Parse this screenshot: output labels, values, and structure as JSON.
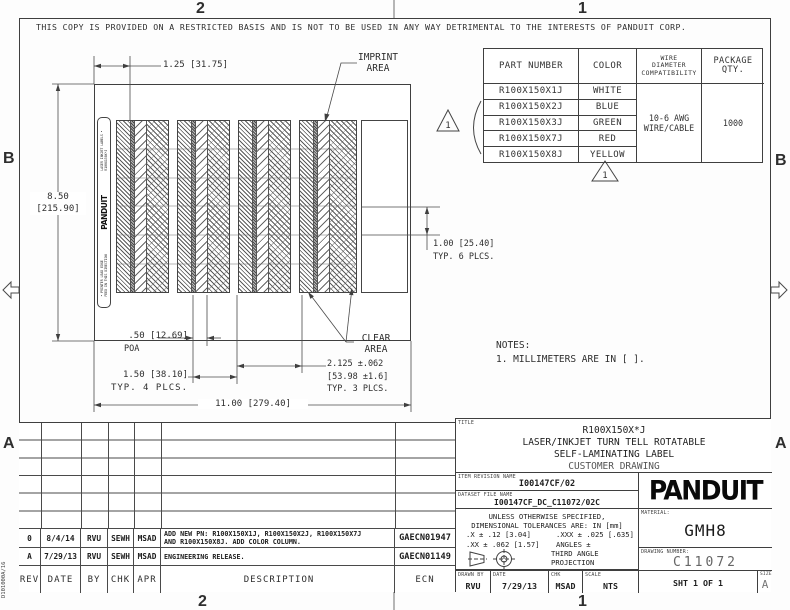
{
  "zone_labels": {
    "top_left": "2",
    "top_right": "1",
    "bottom_left": "2",
    "bottom_right": "1",
    "left_upper": "B",
    "left_lower": "A",
    "right_upper": "B",
    "right_lower": "A"
  },
  "notice": "THIS COPY IS PROVIDED ON A RESTRICTED BASIS AND IS NOT TO BE USED IN ANY WAY DETRIMENTAL TO THE INTERESTS OF PANDUIT CORP.",
  "doc_code": "D101000A/16",
  "flags": {
    "note1": "1"
  },
  "parts_table": {
    "headers": {
      "part_number": "PART NUMBER",
      "color": "COLOR",
      "wire": "WIRE\nDIAMETER\nCOMPATIBILITY",
      "qty": "PACKAGE\nQTY."
    },
    "rows": [
      {
        "pn": "R100X150X1J",
        "color": "WHITE"
      },
      {
        "pn": "R100X150X2J",
        "color": "BLUE"
      },
      {
        "pn": "R100X150X3J",
        "color": "GREEN"
      },
      {
        "pn": "R100X150X7J",
        "color": "RED"
      },
      {
        "pn": "R100X150X8J",
        "color": "YELLOW"
      }
    ],
    "wire_compat": "10-6 AWG\nWIRE/CABLE",
    "package_qty": "1000"
  },
  "label_sheet": {
    "strip": {
      "feed": "• PRINTER LEAD EDGE\nFEED IN THIS DIRECTION",
      "logo": "PANDUIT",
      "type": "LASER INKJET LABELS •\nR100X150X*J"
    }
  },
  "dims": {
    "width_col": "1.25 [31.75]",
    "height": "8.50\n[215.90]",
    "row": "1.00 [25.40]\nTYP. 6 PLCS.",
    "poa": ".50 [12.69]",
    "poa_sub": "POA",
    "pitch": "1.50 [38.10]",
    "pitch_sub": "TYP. 4 PLCS.",
    "label_w": "2.125 ±.062\n[53.98 ±1.6]\nTYP. 3 PLCS.",
    "sheet_w": "11.00 [279.40]",
    "imprint": "IMPRINT\nAREA",
    "clear": "CLEAR\nAREA"
  },
  "notes": {
    "heading": "NOTES:",
    "note1": "1. MILLIMETERS ARE IN [   ]."
  },
  "title_block": {
    "title_label": "TITLE",
    "title1": "R100X150X*J",
    "title2": "LASER/INKJET TURN TELL ROTATABLE",
    "title3": "SELF-LAMINATING LABEL",
    "title4": "CUSTOMER DRAWING",
    "item_rev_label": "ITEM REVISION NAME",
    "item_rev": "I00147CF/02",
    "dataset_label": "DATASET FILE NAME",
    "dataset": "I00147CF_DC_C11072/02C",
    "logo": "PANDUIT",
    "tol1": "UNLESS OTHERWISE SPECIFIED,",
    "tol2": "DIMENSIONAL TOLERANCES ARE: IN [mm]",
    "tol_x": ".X ± .12 [3.04]",
    "tol_xxx": ".XXX ± .025 [.635]",
    "tol_xx": ".XX ± .062 [1.57]",
    "tol_ang": "ANGLES ±",
    "projection": "THIRD ANGLE\nPROJECTION",
    "material_label": "MATERIAL:",
    "material": "GMH8",
    "drawing_number_label": "DRAWING NUMBER:",
    "drawing_number": "C11072",
    "drawn_by_label": "DRAWN BY",
    "drawn_by": "RVU",
    "date_label": "DATE",
    "date": "7/29/13",
    "chk_label": "CHK",
    "chk": "MSAD",
    "scale_label": "SCALE",
    "scale": "NTS",
    "sheet": "SHT 1 OF 1",
    "size_label": "SIZE",
    "size": "A"
  },
  "revision_table": {
    "headers": [
      "REV",
      "DATE",
      "BY",
      "CHK",
      "APR",
      "DESCRIPTION",
      "ECN"
    ],
    "rows": [
      {
        "rev": "0",
        "date": "8/4/14",
        "by": "RVU",
        "chk": "SEWH",
        "apr": "MSAD",
        "description": "ADD NEW PN: R100X150X1J, R100X150X2J, R100X150X7J\nAND R100X150X8J. ADD COLOR COLUMN.",
        "ecn": "GAECN01947"
      },
      {
        "rev": "A",
        "date": "7/29/13",
        "by": "RVU",
        "chk": "SEWH",
        "apr": "MSAD",
        "description": "ENGINEERING RELEASE.",
        "ecn": "GAECN01149"
      }
    ]
  }
}
